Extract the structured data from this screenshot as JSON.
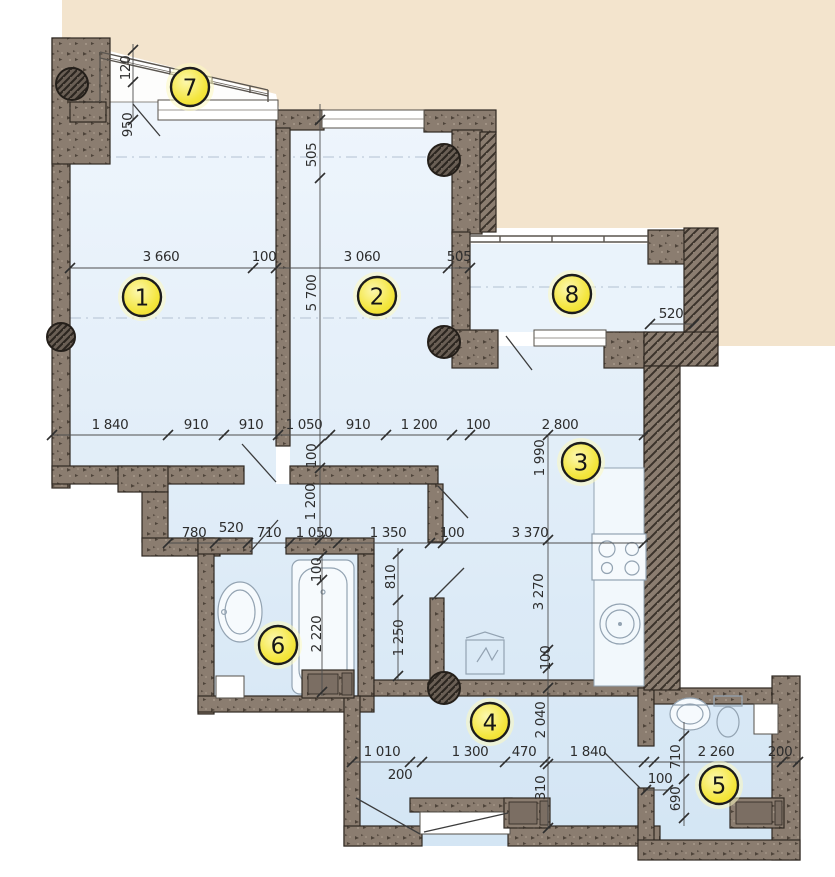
{
  "page": {
    "title": "Apartment floor plan with room numbers and dimensions"
  },
  "colors": {
    "wall": "#8b7d70",
    "wall_dark": "#3b332b",
    "room_fill_top": "#edf4fb",
    "room_fill_bottom": "#d5e6f4",
    "exterior_beige": "#f3e4cd",
    "badge_yellow": "#f4e63e",
    "badge_glow": "#fcf7ae",
    "dim_text": "#2d2d2d"
  },
  "rooms": [
    {
      "number": "1",
      "cx": 142,
      "cy": 297
    },
    {
      "number": "2",
      "cx": 377,
      "cy": 296
    },
    {
      "number": "3",
      "cx": 581,
      "cy": 462
    },
    {
      "number": "4",
      "cx": 490,
      "cy": 722
    },
    {
      "number": "5",
      "cx": 719,
      "cy": 785
    },
    {
      "number": "6",
      "cx": 278,
      "cy": 645
    },
    {
      "number": "7",
      "cx": 190,
      "cy": 87
    },
    {
      "number": "8",
      "cx": 572,
      "cy": 294
    }
  ],
  "dimensions": {
    "horizontal": [
      {
        "text": "3 660",
        "x": 161,
        "y": 261
      },
      {
        "text": "100",
        "x": 264,
        "y": 261
      },
      {
        "text": "3 060",
        "x": 362,
        "y": 261
      },
      {
        "text": "505",
        "x": 459,
        "y": 261
      },
      {
        "text": "520",
        "x": 671,
        "y": 318
      },
      {
        "text": "1 840",
        "x": 110,
        "y": 429
      },
      {
        "text": "910",
        "x": 196,
        "y": 429
      },
      {
        "text": "910",
        "x": 251,
        "y": 429
      },
      {
        "text": "1 050",
        "x": 304,
        "y": 429
      },
      {
        "text": "910",
        "x": 358,
        "y": 429
      },
      {
        "text": "1 200",
        "x": 419,
        "y": 429
      },
      {
        "text": "100",
        "x": 478,
        "y": 429
      },
      {
        "text": "2 800",
        "x": 560,
        "y": 429
      },
      {
        "text": "780",
        "x": 194,
        "y": 537
      },
      {
        "text": "520",
        "x": 231,
        "y": 532
      },
      {
        "text": "710",
        "x": 269,
        "y": 537
      },
      {
        "text": "1 050",
        "x": 314,
        "y": 537
      },
      {
        "text": "1 350",
        "x": 388,
        "y": 537
      },
      {
        "text": "100",
        "x": 452,
        "y": 537
      },
      {
        "text": "3 370",
        "x": 530,
        "y": 537
      },
      {
        "text": "1 010",
        "x": 382,
        "y": 756
      },
      {
        "text": "200",
        "x": 400,
        "y": 779
      },
      {
        "text": "1 300",
        "x": 470,
        "y": 756
      },
      {
        "text": "470",
        "x": 524,
        "y": 756
      },
      {
        "text": "1 840",
        "x": 588,
        "y": 756
      },
      {
        "text": "100",
        "x": 660,
        "y": 783
      },
      {
        "text": "2 260",
        "x": 716,
        "y": 756
      },
      {
        "text": "200",
        "x": 780,
        "y": 756
      }
    ],
    "vertical": [
      {
        "text": "120",
        "x": 130,
        "y": 68
      },
      {
        "text": "950",
        "x": 132,
        "y": 125
      },
      {
        "text": "505",
        "x": 316,
        "y": 155
      },
      {
        "text": "5 700",
        "x": 316,
        "y": 293
      },
      {
        "text": "100",
        "x": 316,
        "y": 456
      },
      {
        "text": "1 200",
        "x": 315,
        "y": 502
      },
      {
        "text": "1 990",
        "x": 544,
        "y": 458
      },
      {
        "text": "3 270",
        "x": 543,
        "y": 592
      },
      {
        "text": "810",
        "x": 395,
        "y": 577
      },
      {
        "text": "1 250",
        "x": 403,
        "y": 638
      },
      {
        "text": "100",
        "x": 321,
        "y": 570
      },
      {
        "text": "2 220",
        "x": 321,
        "y": 634
      },
      {
        "text": "100",
        "x": 550,
        "y": 658
      },
      {
        "text": "2 040",
        "x": 545,
        "y": 720
      },
      {
        "text": "310",
        "x": 545,
        "y": 788
      },
      {
        "text": "710",
        "x": 680,
        "y": 757
      },
      {
        "text": "690",
        "x": 680,
        "y": 799
      }
    ]
  },
  "fixture_icons": [
    "bathtub-icon",
    "bathroom-sink-icon",
    "kitchen-stove-icon",
    "kitchen-sink-icon",
    "fridge-icon",
    "wc-sink-icon",
    "toilet-icon",
    "washer-icon",
    "wardrobe-icon",
    "column-icon"
  ]
}
